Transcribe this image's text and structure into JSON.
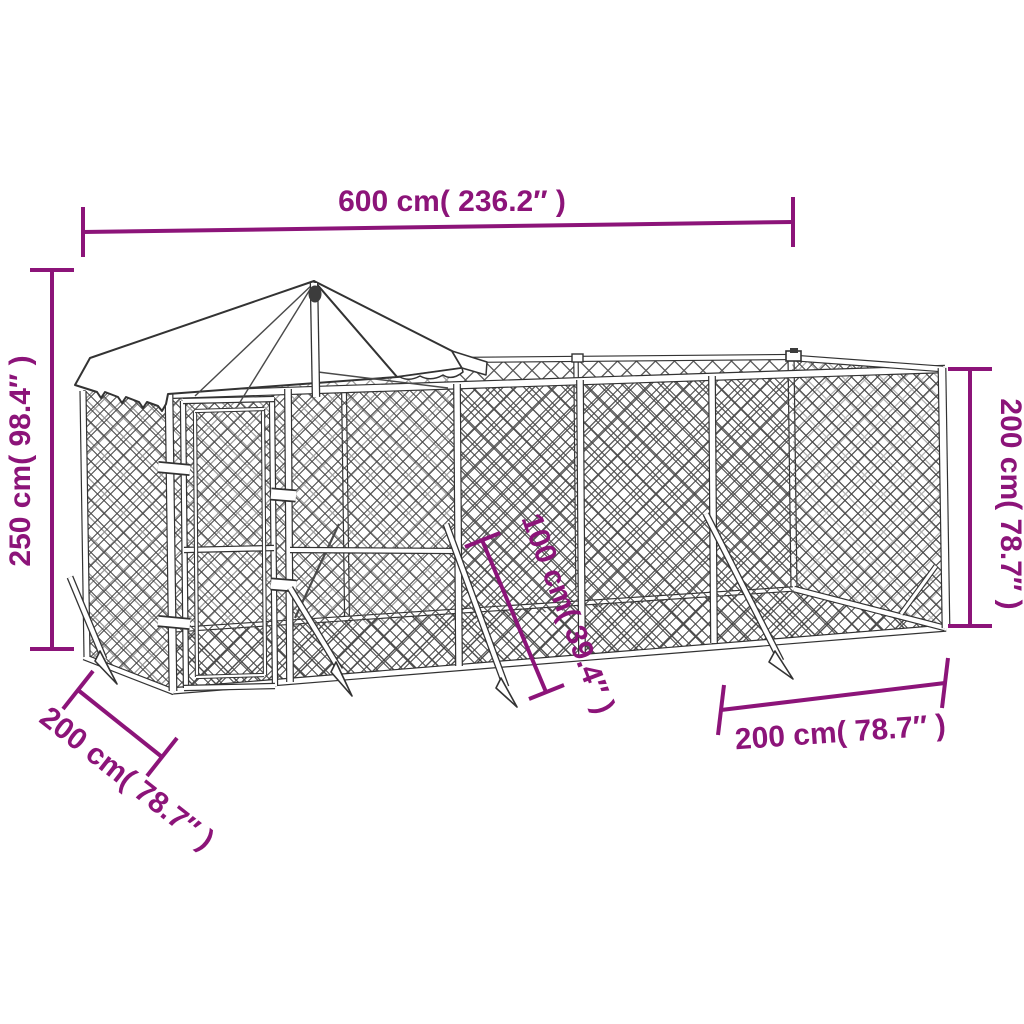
{
  "diagram": {
    "accent_color": "#8C1479",
    "frame_color": "#333333",
    "mesh_color": "#4C4C4C",
    "background_color": "#FFFFFF",
    "dimensions": {
      "length": {
        "label": "600 cm( 236.2″ )"
      },
      "height_left": {
        "label": "250 cm( 98.4″ )"
      },
      "height_right": {
        "label": "200 cm( 78.7″ )"
      },
      "depth_left": {
        "label": "200 cm( 78.7″ )"
      },
      "width_right": {
        "label": "200 cm( 78.7″ )"
      },
      "stake": {
        "label": "100 cm( 39.4″ )"
      }
    }
  }
}
